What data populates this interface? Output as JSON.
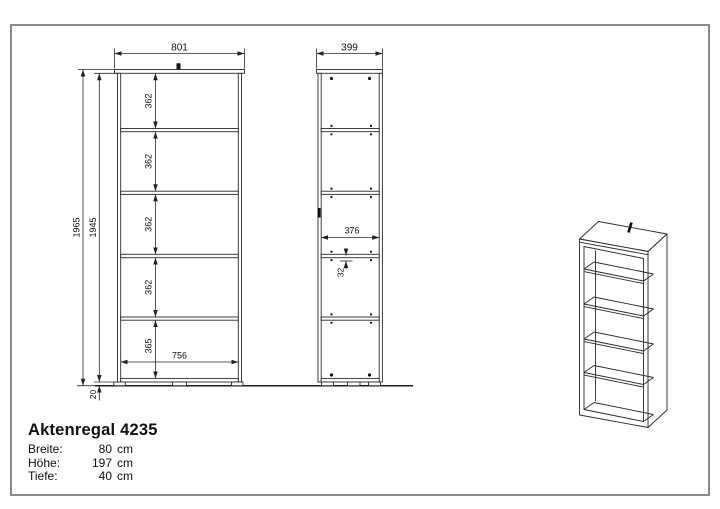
{
  "doc": {
    "title": "Aktenregal 4235",
    "specs": [
      {
        "label": "Breite:",
        "num": "80",
        "unit": "cm"
      },
      {
        "label": "Höhe:",
        "num": "197",
        "unit": "cm"
      },
      {
        "label": "Tiefe:",
        "num": "40",
        "unit": "cm"
      }
    ]
  },
  "front_view": {
    "width": "801",
    "height_total": "1965",
    "height_body": "1945",
    "compartments": [
      "362",
      "362",
      "362",
      "362",
      "365"
    ],
    "inner_width": "756",
    "plinth": "20"
  },
  "side_view": {
    "depth": "399",
    "inner_depth": "376",
    "hole_offset": "32"
  },
  "drawing": {
    "line_color": "#2b2b2b",
    "frame_color": "#8b8b8b"
  }
}
